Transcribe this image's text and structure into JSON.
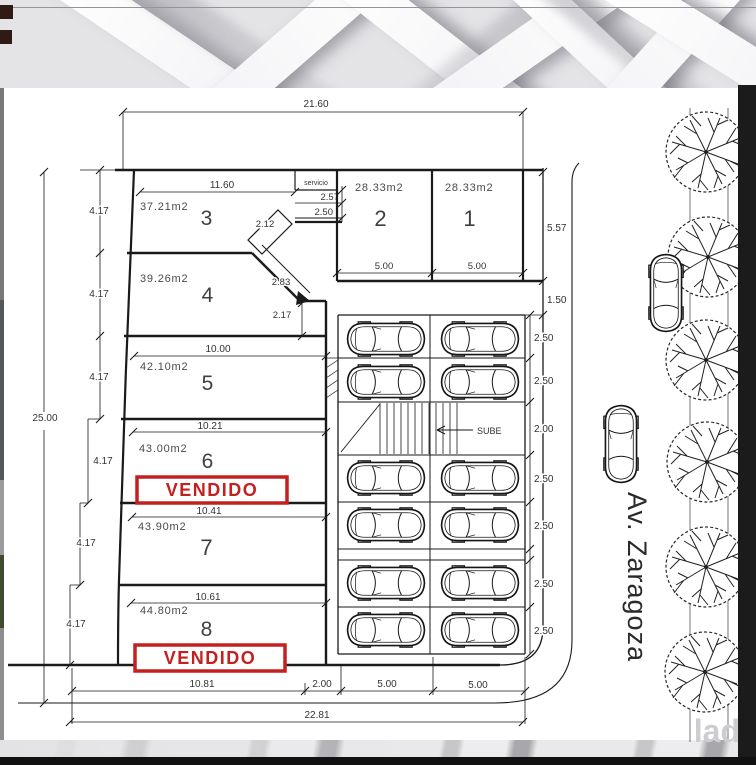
{
  "drawing": {
    "street_label": "Av. Zaragoza",
    "sold_label": "VENDIDO",
    "service_label": "servicio",
    "ramp_label": "SUBE",
    "watermark": "lad",
    "lots": [
      {
        "num": "1",
        "area": "28.33m2"
      },
      {
        "num": "2",
        "area": "28.33m2"
      },
      {
        "num": "3",
        "area": "37.21m2"
      },
      {
        "num": "4",
        "area": "39.26m2"
      },
      {
        "num": "5",
        "area": "42.10m2"
      },
      {
        "num": "6",
        "area": "43.00m2"
      },
      {
        "num": "7",
        "area": "43.90m2"
      },
      {
        "num": "8",
        "area": "44.80m2"
      }
    ],
    "dims": {
      "top_width": "21.60",
      "lot3_width": "11.60",
      "left_depth": "25.00",
      "bottom_total": "22.81",
      "bottom_left": "10.81",
      "bottom_mid": "2.00",
      "bottom_l1": "5.00",
      "bottom_l2": "5.00",
      "lot1_width": "5.00",
      "lot2_width": "5.00",
      "lots_depth": "5.57",
      "gap": "1.50",
      "svc_a": "2.57",
      "svc_b": "2.50",
      "chamfer_a": "2.12",
      "chamfer_b": "2.83",
      "chamfer_c": "2.17",
      "lot_depth": "4.17",
      "lot5_top": "10.00",
      "lot5_bottom": "10.21",
      "lot6_bottom": "10.41",
      "lot7_bottom": "10.61"
    },
    "parking_row_dims": [
      "2.50",
      "2.50",
      "2.00",
      "2.50",
      "2.50",
      "2.50",
      "2.50"
    ]
  }
}
